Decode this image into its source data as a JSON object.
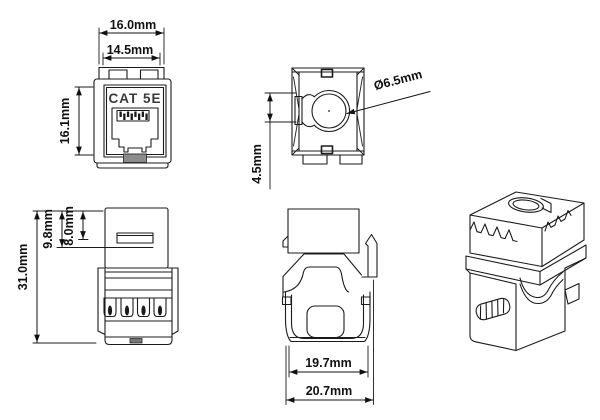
{
  "drawing": {
    "part_label": "CAT 5E",
    "background": "#ffffff",
    "line_color": "#1b1b1b",
    "views": {
      "front": {
        "label": "front-view",
        "part_label": "CAT 5E",
        "dim_outer_width": "16.0mm",
        "dim_inner_width": "14.5mm",
        "dim_height": "16.1mm"
      },
      "top": {
        "label": "top-view",
        "dim_hole_diameter": "Ø6.5mm",
        "dim_offset": "4.5mm"
      },
      "side": {
        "label": "side-view",
        "dim_overall_height": "31.0mm",
        "dim_back_height": "9.8mm",
        "dim_window_height": "8.0mm"
      },
      "rear": {
        "label": "rear-view",
        "dim_body_width": "19.7mm",
        "dim_overall_width": "20.7mm"
      },
      "isometric": {
        "label": "isometric-view"
      }
    }
  }
}
